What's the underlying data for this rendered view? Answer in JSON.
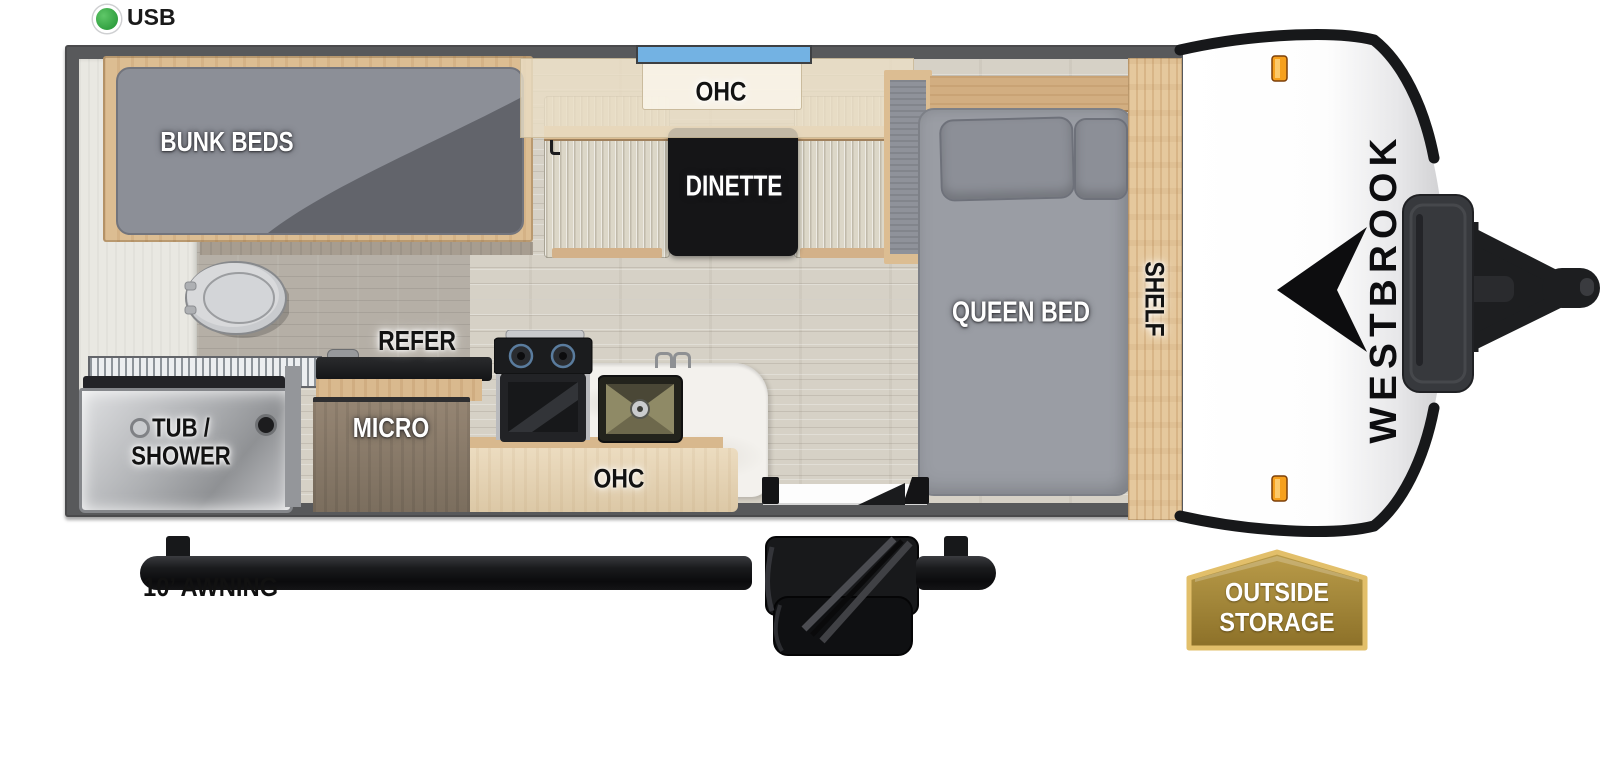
{
  "legend": {
    "usb": "USB"
  },
  "labels": {
    "bunk_beds": "BUNK BEDS",
    "ohc_dinette": "OHC",
    "dinette": "DINETTE",
    "queen_bed": "QUEEN BED",
    "shelf": "SHELF",
    "refer": "REFER",
    "micro": "MICRO",
    "ohc_kitchen": "OHC",
    "tub_shower_line1": "TUB /",
    "tub_shower_line2": "SHOWER"
  },
  "exterior": {
    "awning": "10’ AWNING",
    "brand": "WESTBROOK",
    "badge_line1": "OUTSIDE",
    "badge_line2": "STORAGE"
  },
  "colors": {
    "wall": "#58595b",
    "floor_wood": "#d6d1c6",
    "cabinet_wood": "#dcbd92",
    "mattress_gray": "#9a9da4",
    "window_blue": "#73b2e3",
    "marker_orange": "#f6a01d",
    "usb_green": "#3fae49",
    "badge_gold": "#b3953f",
    "badge_border": "#e2bf6a"
  }
}
